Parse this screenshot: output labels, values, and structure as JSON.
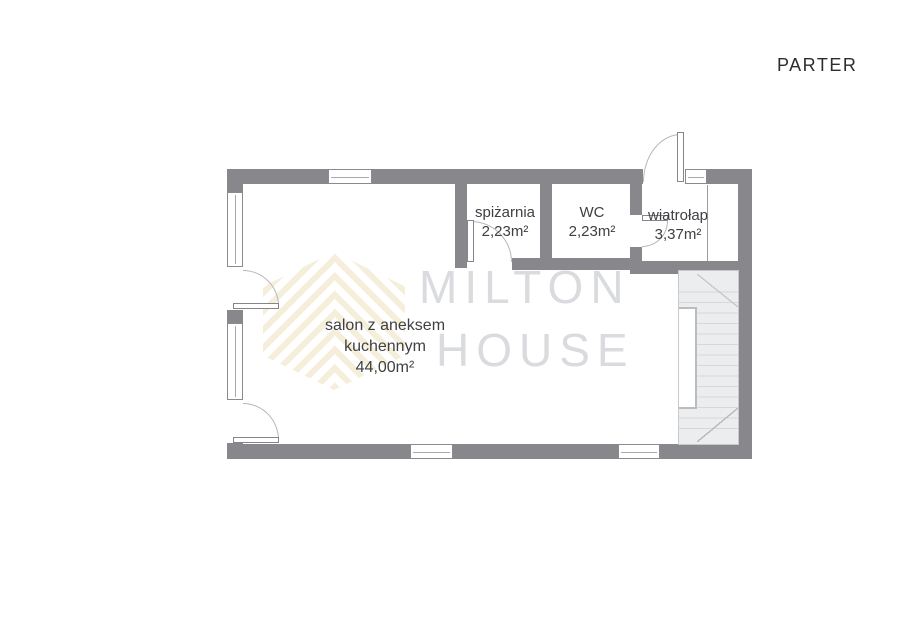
{
  "title": "PARTER",
  "watermark": {
    "brand_line1": "MILTON",
    "brand_line2": "HOUSE"
  },
  "rooms": [
    {
      "name": "spiżarnia",
      "area": "2,23m²"
    },
    {
      "name": "WC",
      "area": "2,23m²"
    },
    {
      "name": "wiatrołap",
      "area": "3,37m²"
    },
    {
      "name": "salon z aneksem",
      "name2": "kuchennym",
      "area": "44,00m²"
    }
  ],
  "colors": {
    "wall": "#88888c",
    "stair_fill": "#ecedee",
    "watermark_text": "#d9dbde",
    "logo_stripe": "#f5eedb",
    "label_text": "#3f4043"
  }
}
